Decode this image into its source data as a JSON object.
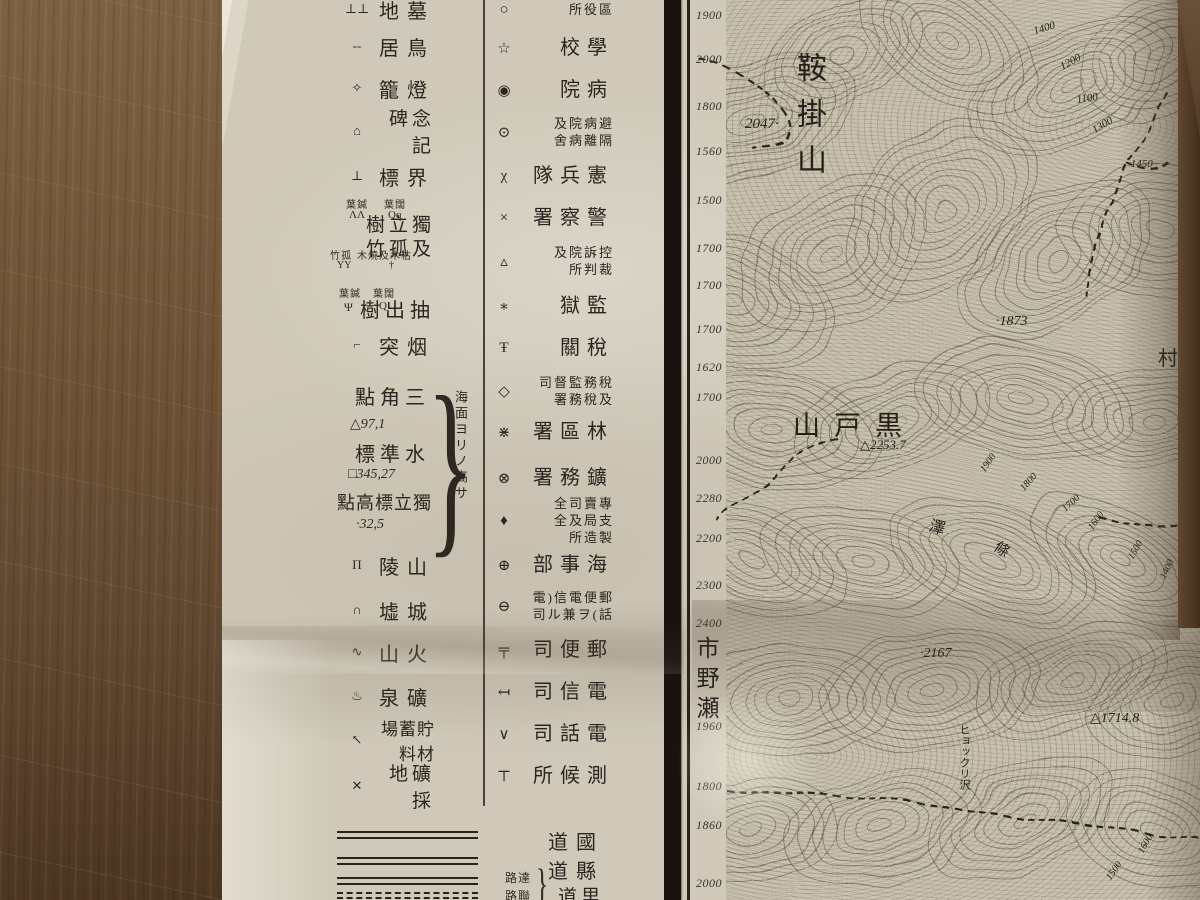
{
  "colors": {
    "wood": "#6b5036",
    "paper": "#d0c9b9",
    "map_paper": "#c8c1ae",
    "ink": "#2b251f",
    "neatline": "#191310"
  },
  "legend": {
    "left_rows": [
      {
        "icon": "cemetery-icon",
        "glyph": "⊥⊥",
        "label": "地墓",
        "top": -4,
        "cls": "biglab"
      },
      {
        "icon": "torii-icon",
        "glyph": "--",
        "label": "居鳥",
        "top": 33,
        "cls": "biglab"
      },
      {
        "icon": "stone-lantern-icon",
        "glyph": "✧",
        "label": "籠燈",
        "top": 75,
        "cls": "biglab"
      },
      {
        "icon": "monument-icon",
        "glyph": "⌂",
        "label": "碑念記",
        "top": 118,
        "cls": "midlab"
      },
      {
        "icon": "boundary-marker-icon",
        "glyph": "⊥",
        "label": "標界",
        "top": 163,
        "cls": "biglab"
      },
      {
        "icon": "chimney-icon",
        "glyph": "⌐",
        "label": "突烟",
        "top": 332,
        "cls": "biglab"
      },
      {
        "icon": "mountain-ridge-icon",
        "glyph": "Π",
        "label": "陵山",
        "top": 552,
        "cls": "biglab"
      },
      {
        "icon": "castle-ruins-icon",
        "glyph": "∩",
        "label": "墟城",
        "top": 597,
        "cls": "biglab"
      },
      {
        "icon": "volcano-icon",
        "glyph": "∿",
        "label": "山火",
        "top": 639,
        "cls": "biglab"
      },
      {
        "icon": "mineral-spring-icon",
        "glyph": "♨",
        "label": "泉礦",
        "top": 683,
        "cls": "biglab"
      },
      {
        "icon": "lumber-depot-icon",
        "glyph": "↖",
        "label": "場蓄貯料材",
        "top": 727,
        "cls": "longlab"
      },
      {
        "icon": "mining-site-icon",
        "glyph": "✕",
        "label": "地礦採",
        "top": 773,
        "cls": "midlab"
      }
    ],
    "tree_row": {
      "small_left": "葉鍼",
      "small_right": "葉闊",
      "sym_left": "ΛΛ",
      "sym_right": "Qq",
      "line1": "樹立獨",
      "line2": "竹孤及",
      "small2_left": "竹孤",
      "small2_right": "木燒及木枯",
      "sym2_left": "ΥΥ",
      "sym2_right": "†"
    },
    "extract_row": {
      "small_left": "葉鍼",
      "small_right": "葉闊",
      "sym_left": "Ψ",
      "sym_right": "Q",
      "label": "樹出抽"
    },
    "survey": {
      "tri_label": "點角三",
      "tri_value": "△97,1",
      "bm_label": "標準水",
      "bm_value": "□345,27",
      "spot_label": "點高標立獨",
      "spot_value": "·32,5",
      "note": "海面ヨリノ高サ",
      "brace": "}"
    },
    "right_rows": [
      {
        "icon": "ward-office-icon",
        "glyph": "○",
        "lines": [
          "所役區"
        ],
        "top": 2,
        "big": false
      },
      {
        "icon": "school-icon",
        "glyph": "☆",
        "lines": [
          "校學"
        ],
        "top": 38,
        "big": true
      },
      {
        "icon": "hospital-icon",
        "glyph": "◉",
        "lines": [
          "院病"
        ],
        "top": 80,
        "big": true
      },
      {
        "icon": "isolation-hospital-icon",
        "glyph": "⊙",
        "lines": [
          "及院病避",
          "舍病離隔"
        ],
        "top": 116,
        "big": false
      },
      {
        "icon": "military-police-icon",
        "glyph": "χ",
        "lines": [
          "隊兵憲"
        ],
        "top": 166,
        "big": true
      },
      {
        "icon": "police-station-icon",
        "glyph": "×",
        "lines": [
          "署察警"
        ],
        "top": 208,
        "big": true
      },
      {
        "icon": "court-icon",
        "glyph": "▵",
        "lines": [
          "及院訴控",
          "所判裁"
        ],
        "top": 245,
        "big": false
      },
      {
        "icon": "prison-icon",
        "glyph": "∗",
        "lines": [
          "獄監"
        ],
        "top": 296,
        "big": true
      },
      {
        "icon": "customs-icon",
        "glyph": "Ŧ",
        "lines": [
          "關稅"
        ],
        "top": 338,
        "big": true
      },
      {
        "icon": "tax-office-icon",
        "glyph": "◇",
        "lines": [
          "司督監務稅",
          "署務稅及"
        ],
        "top": 375,
        "big": false
      },
      {
        "icon": "forestry-office-icon",
        "glyph": "⋇",
        "lines": [
          "署區林"
        ],
        "top": 422,
        "big": true
      },
      {
        "icon": "mining-office-icon",
        "glyph": "⊗",
        "lines": [
          "署務鑛"
        ],
        "top": 468,
        "big": true
      },
      {
        "icon": "monopoly-bureau-icon",
        "glyph": "♦",
        "lines": [
          "全司賣專",
          "全及局支",
          "所造製"
        ],
        "top": 496,
        "big": false
      },
      {
        "icon": "maritime-office-icon",
        "glyph": "⊕",
        "lines": [
          "部事海"
        ],
        "top": 555,
        "big": true
      },
      {
        "icon": "post-telegraph-telephone-icon",
        "glyph": "⊖",
        "lines": [
          "電)信電便郵",
          "司ル兼ヲ(話"
        ],
        "top": 590,
        "big": false
      },
      {
        "icon": "post-office-icon",
        "glyph": "╤",
        "lines": [
          "司便郵"
        ],
        "top": 640,
        "big": true
      },
      {
        "icon": "telegraph-office-icon",
        "glyph": "↤",
        "lines": [
          "司信電"
        ],
        "top": 682,
        "big": true
      },
      {
        "icon": "telephone-office-icon",
        "glyph": "∨",
        "lines": [
          "司話電"
        ],
        "top": 724,
        "big": true
      },
      {
        "icon": "weather-station-icon",
        "glyph": "⊤",
        "lines": [
          "所候測"
        ],
        "top": 766,
        "big": true
      }
    ],
    "roads": {
      "kokudo": "道國",
      "kendo": "道縣",
      "rido": "道里",
      "small_top": "路達",
      "small_bottom": "路聯",
      "brace": "}"
    }
  },
  "map": {
    "adjacent_sheet": "市野瀬",
    "margin_labels": [
      {
        "t": "1900",
        "y": 8
      },
      {
        "t": "2000",
        "y": 52
      },
      {
        "t": "1800",
        "y": 99
      },
      {
        "t": "1560",
        "y": 144
      },
      {
        "t": "1500",
        "y": 193
      },
      {
        "t": "1700",
        "y": 241
      },
      {
        "t": "1700",
        "y": 278
      },
      {
        "t": "1700",
        "y": 322
      },
      {
        "t": "1620",
        "y": 360
      },
      {
        "t": "1700",
        "y": 390
      },
      {
        "t": "2000",
        "y": 453
      },
      {
        "t": "2280",
        "y": 491
      },
      {
        "t": "2200",
        "y": 531
      },
      {
        "t": "2300",
        "y": 578
      },
      {
        "t": "2400",
        "y": 616
      },
      {
        "t": "1960",
        "y": 719
      },
      {
        "t": "1800",
        "y": 779
      },
      {
        "t": "1860",
        "y": 818
      },
      {
        "t": "2000",
        "y": 876
      }
    ],
    "labels": [
      {
        "t": "鞍掛山",
        "x": 786,
        "y": 52,
        "s": 30,
        "vert": true,
        "ls": 16,
        "name": "peak-kurakakeyama"
      },
      {
        "t": "2047·",
        "x": 745,
        "y": 116,
        "s": 15,
        "i": true,
        "name": "spot-height-2047"
      },
      {
        "t": "·1873",
        "x": 996,
        "y": 314,
        "s": 14,
        "i": true,
        "name": "spot-height-1873"
      },
      {
        "t": "山戸黒",
        "x": 793,
        "y": 404,
        "s": 27,
        "ls": 14,
        "name": "peak-kurotoyama"
      },
      {
        "t": "△2253.7",
        "x": 860,
        "y": 437,
        "s": 13,
        "i": true,
        "name": "triangulation-2253-7"
      },
      {
        "t": "村",
        "x": 1158,
        "y": 342,
        "s": 20,
        "name": "village-label"
      },
      {
        "t": "澤",
        "x": 933,
        "y": 512,
        "s": 16,
        "r": 15,
        "name": "sawa-label"
      },
      {
        "t": "條",
        "x": 1002,
        "y": 536,
        "s": 15,
        "r": 35,
        "name": "jo-label"
      },
      {
        "t": "·2167",
        "x": 920,
        "y": 646,
        "s": 14,
        "i": true,
        "name": "spot-height-2167"
      },
      {
        "t": "△1714.8",
        "x": 1090,
        "y": 710,
        "s": 14,
        "i": true,
        "name": "triangulation-1714-8"
      },
      {
        "t": "ヒョックリ沢",
        "x": 956,
        "y": 724,
        "s": 11,
        "vert": true,
        "name": "hyokkuri-sawa"
      },
      {
        "t": "1400",
        "x": 1032,
        "y": 26,
        "s": 11,
        "i": true,
        "r": -18,
        "name": "contour-1400"
      },
      {
        "t": "1200",
        "x": 1058,
        "y": 62,
        "s": 11,
        "i": true,
        "r": -28,
        "name": "contour-1200"
      },
      {
        "t": "1100",
        "x": 1076,
        "y": 94,
        "s": 11,
        "i": true,
        "r": -8,
        "name": "contour-1100"
      },
      {
        "t": "1300",
        "x": 1090,
        "y": 126,
        "s": 11,
        "i": true,
        "r": -32,
        "name": "contour-1300"
      },
      {
        "t": "·1450",
        "x": 1128,
        "y": 158,
        "s": 11,
        "i": true,
        "name": "spot-height-1450"
      },
      {
        "t": "1900",
        "x": 978,
        "y": 468,
        "s": 10,
        "i": true,
        "r": -55,
        "name": "contour-1900"
      },
      {
        "t": "1800",
        "x": 1018,
        "y": 486,
        "s": 10,
        "i": true,
        "r": -48,
        "name": "contour-1800"
      },
      {
        "t": "1700",
        "x": 1060,
        "y": 506,
        "s": 10,
        "i": true,
        "r": -42,
        "name": "contour-1700"
      },
      {
        "t": "1600",
        "x": 1086,
        "y": 526,
        "s": 10,
        "i": true,
        "r": -55,
        "name": "contour-1600"
      },
      {
        "t": "1500",
        "x": 1126,
        "y": 556,
        "s": 10,
        "i": true,
        "r": -60,
        "name": "contour-1500"
      },
      {
        "t": "1400",
        "x": 1158,
        "y": 576,
        "s": 10,
        "i": true,
        "r": -65,
        "name": "contour-1400b"
      },
      {
        "t": "1600",
        "x": 1136,
        "y": 850,
        "s": 10,
        "i": true,
        "r": -60,
        "name": "contour-1600b"
      },
      {
        "t": "1500",
        "x": 1104,
        "y": 876,
        "s": 10,
        "i": true,
        "r": -55,
        "name": "contour-1500b"
      }
    ]
  }
}
